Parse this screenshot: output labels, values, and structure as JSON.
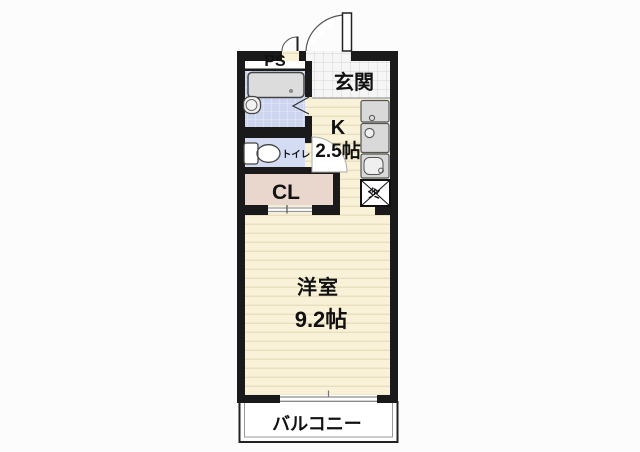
{
  "plan": {
    "labels": {
      "ps": "PS",
      "entrance": "玄関",
      "toilet": "トイレ",
      "closet": "CL",
      "kitchen_letter": "K",
      "kitchen_size": "2.5帖",
      "fridge": "冷",
      "living": "洋室",
      "living_size": "9.2帖",
      "balcony": "バルコニー"
    },
    "rooms": [
      {
        "name": "玄関"
      },
      {
        "name": "K",
        "size": "2.5帖"
      },
      {
        "name": "トイレ"
      },
      {
        "name": "PS"
      },
      {
        "name": "CL"
      },
      {
        "name": "洋室",
        "size": "9.2帖"
      },
      {
        "name": "バルコニー"
      },
      {
        "name": "冷蔵庫置場",
        "shown_as": "冷"
      }
    ],
    "colors": {
      "wall": "#1a1a1a",
      "floor_wood": "#faf2d8",
      "floor_stripe": "#e8dfbf",
      "bath_tile": "#cdd6ee",
      "toilet_floor": "#d4dcf4",
      "closet_floor": "#e9d6cd",
      "entrance_tile": "#f6f6f6",
      "fixture_gray": "#d9d9d9",
      "balcony_bg": "#ffffff"
    }
  }
}
